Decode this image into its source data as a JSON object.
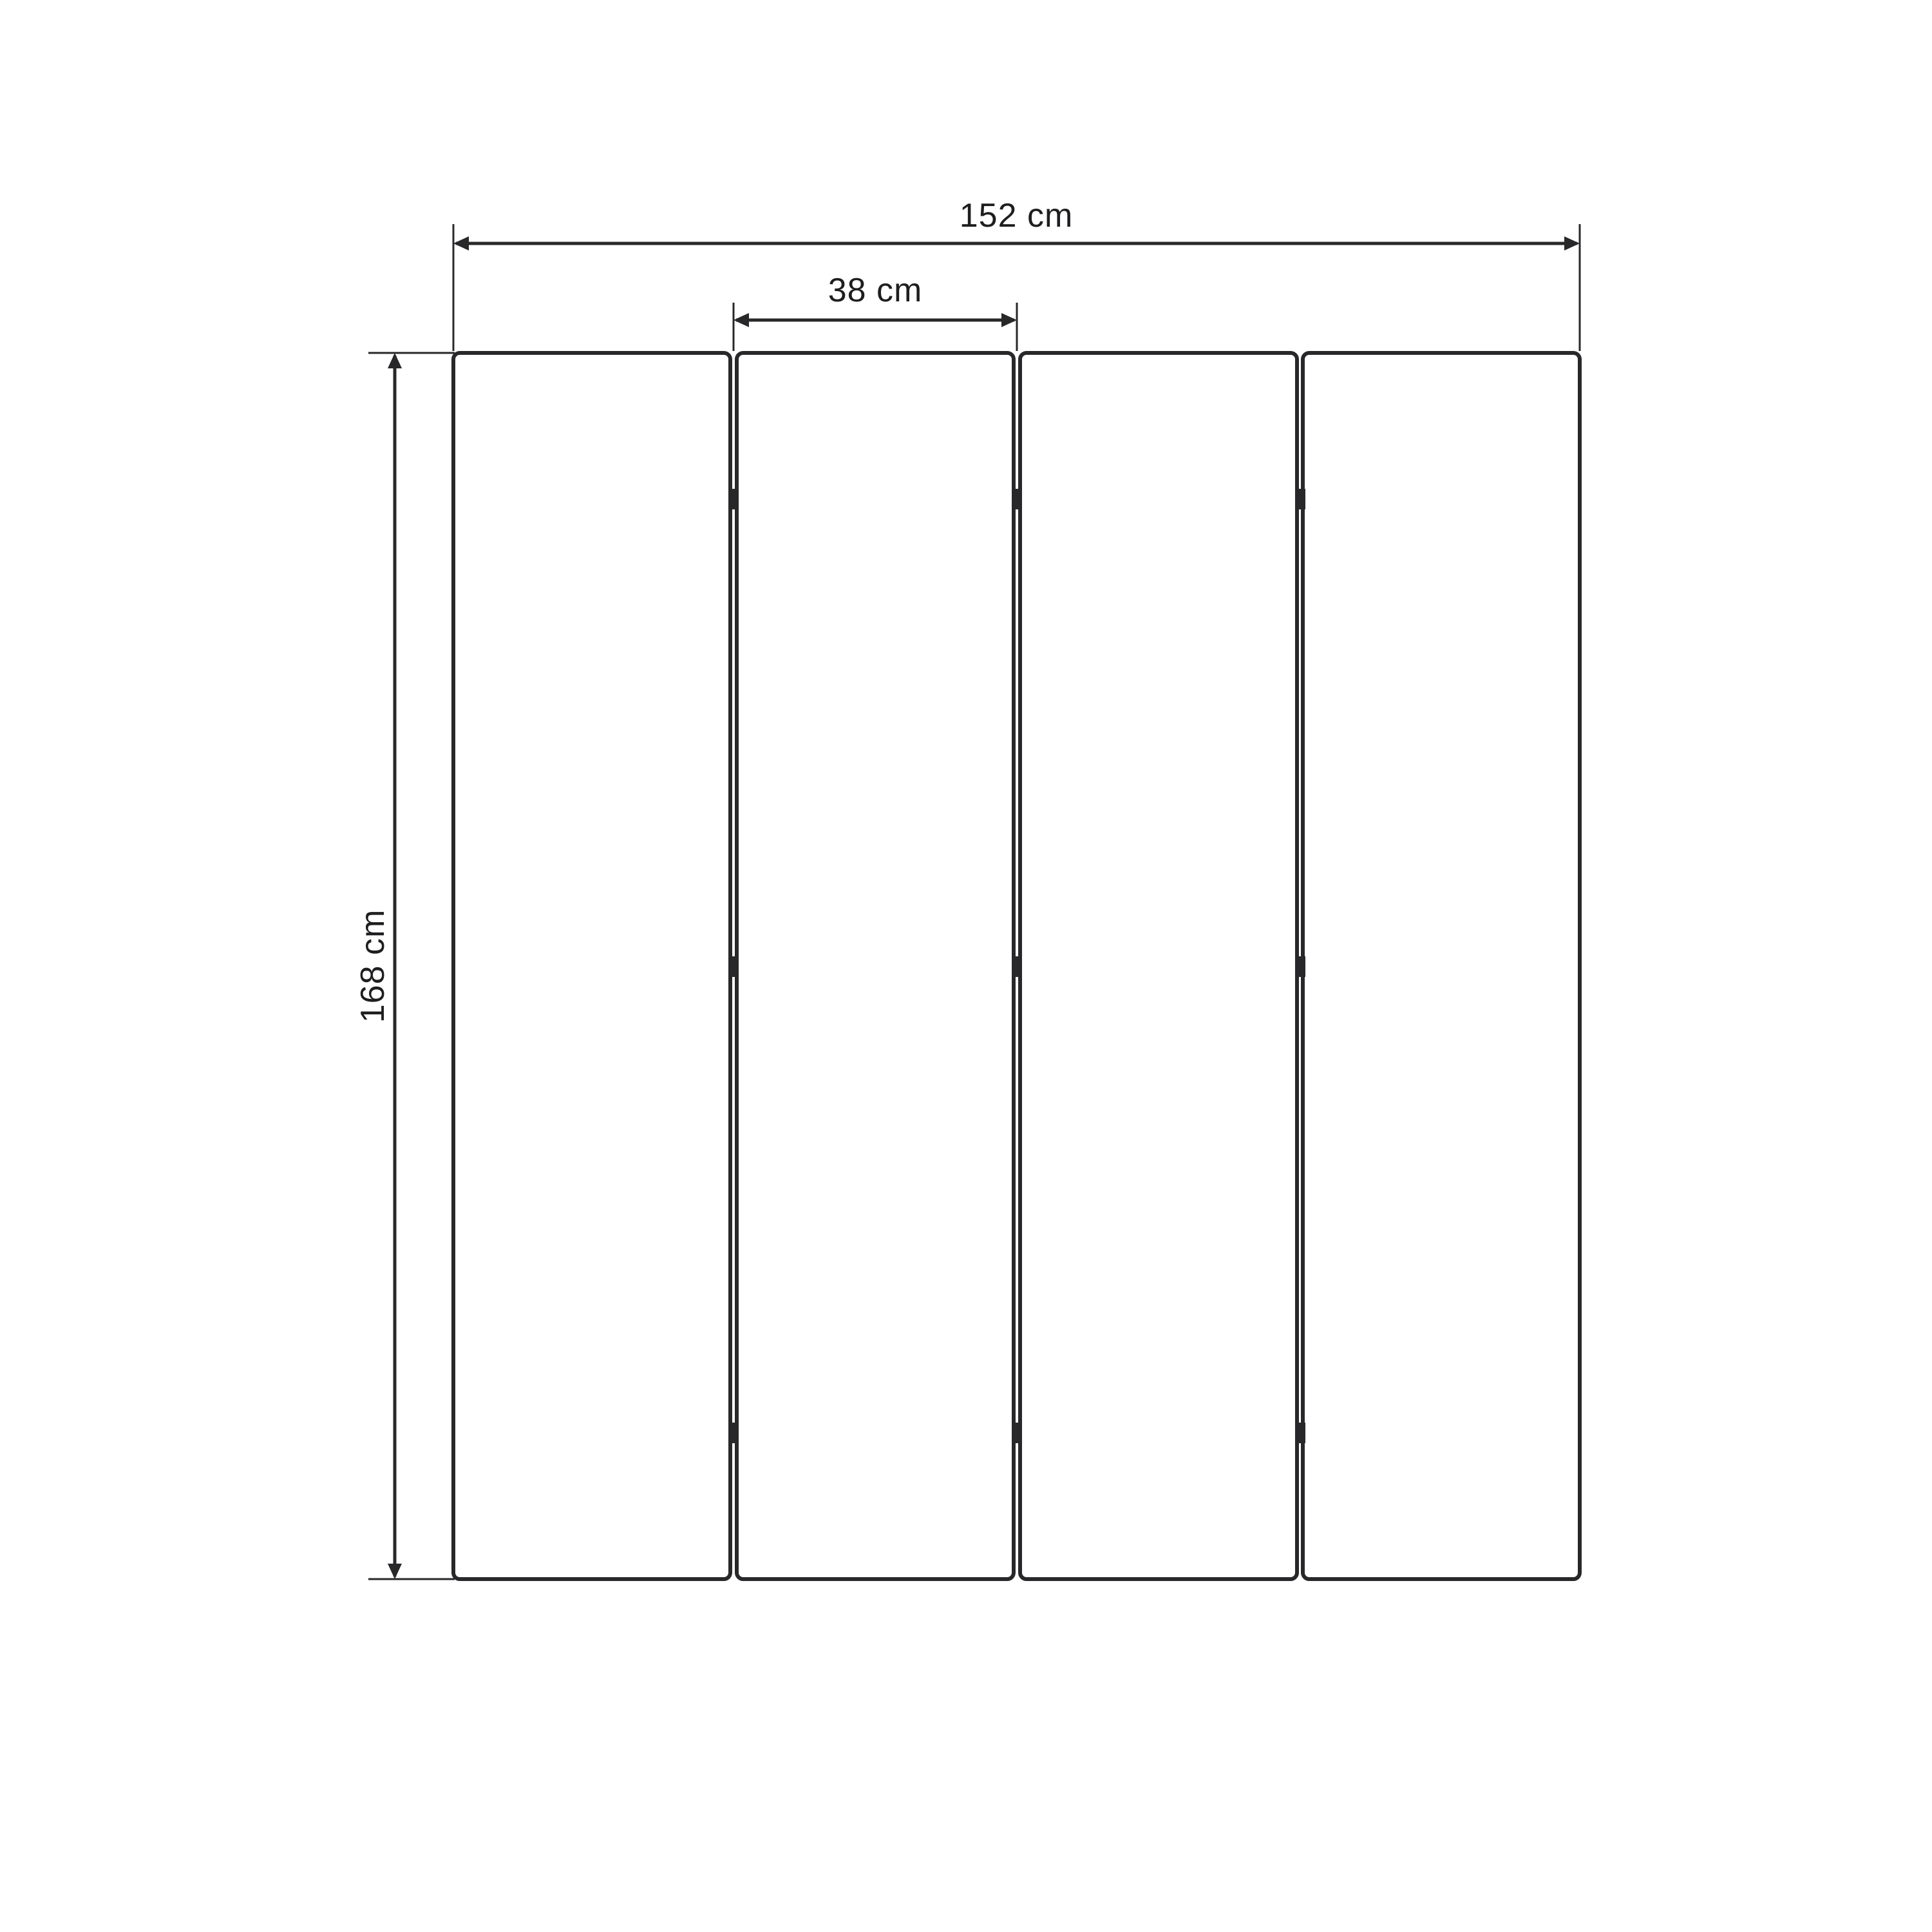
{
  "diagram": {
    "kind": "dimension-drawing",
    "panel_count": 4,
    "hinge_rows": 3,
    "dimensions": {
      "total_width": {
        "label": "152 cm",
        "value": 152,
        "unit": "cm"
      },
      "panel_width": {
        "label": "38 cm",
        "value": 38,
        "unit": "cm"
      },
      "height": {
        "label": "168 cm",
        "value": 168,
        "unit": "cm"
      }
    },
    "colors": {
      "line": "#28282a",
      "text": "#1e1e20",
      "background": "#ffffff"
    }
  }
}
